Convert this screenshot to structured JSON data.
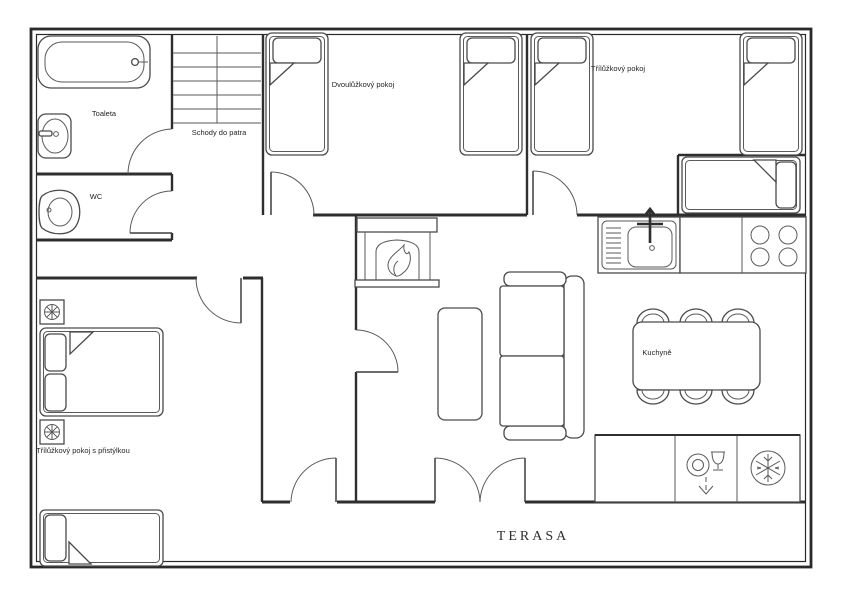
{
  "plan": {
    "title": "Apartment floor plan",
    "rooms": {
      "toaleta": "Toaleta",
      "wc": "WC",
      "stairs": "Schody do patra",
      "double_bedroom": "Dvoulůžkový pokoj",
      "triple_bedroom": "Třílůžkový pokoj",
      "kitchen": "Kuchyně",
      "triple_bedroom_with_extra_bed": "Třílůžkový pokoj s přistýlkou",
      "terrace": "TERASA"
    },
    "colors": {
      "wall": "#2e2e2e",
      "furniture_line": "#4a4a4a",
      "background": "#ffffff"
    }
  }
}
